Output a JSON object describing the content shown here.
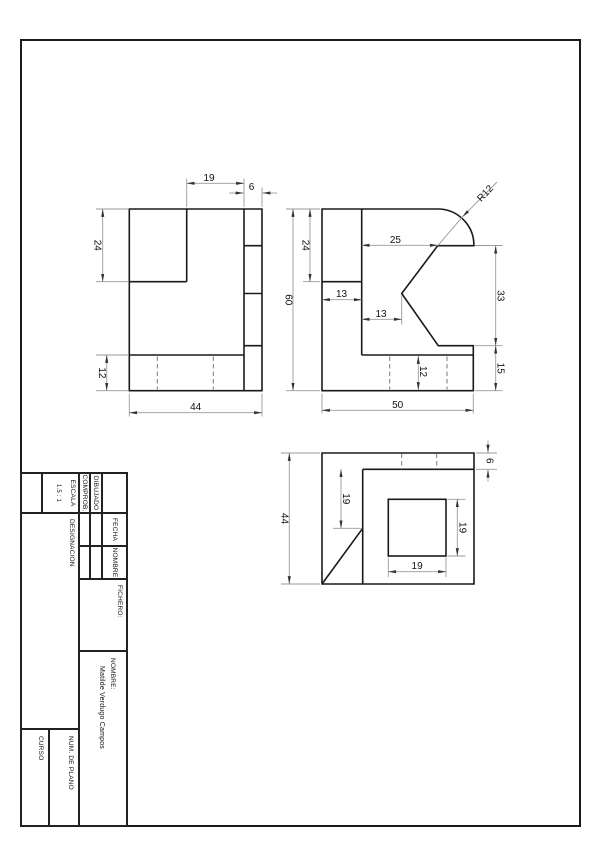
{
  "dims": {
    "front_width_19": "19",
    "front_col_6": "6",
    "front_notch_24": "24",
    "front_base_12": "12",
    "front_total_44": "44",
    "side_height_60": "60",
    "side_step_24": "24",
    "side_offset_13": "13",
    "side_offset2_13": "13",
    "side_top_25": "25",
    "side_radius": "R12",
    "side_notch_33": "33",
    "side_bottom_15": "15",
    "side_base_12": "12",
    "side_width_50": "50",
    "top_depth_44": "44",
    "top_strip_6": "6",
    "top_left_19": "19",
    "top_square_19a": "19",
    "top_square_19b": "19"
  },
  "title_block": {
    "fecha": "FECHA",
    "nombre_col": "NOMBRE",
    "dibujado": "DIBUJADO",
    "comprob": "COMPROB.",
    "fichero": "FICHERO:",
    "escala": "ESCALA",
    "escala_value": "1.5 : 1",
    "designacion": "DESIGNACION",
    "nombre_label": "NOMBRE:",
    "nombre_value": "Matilde Verdugo Campos",
    "num_de_plano": "NUM. DE PLANO",
    "curso": "CURSO"
  }
}
